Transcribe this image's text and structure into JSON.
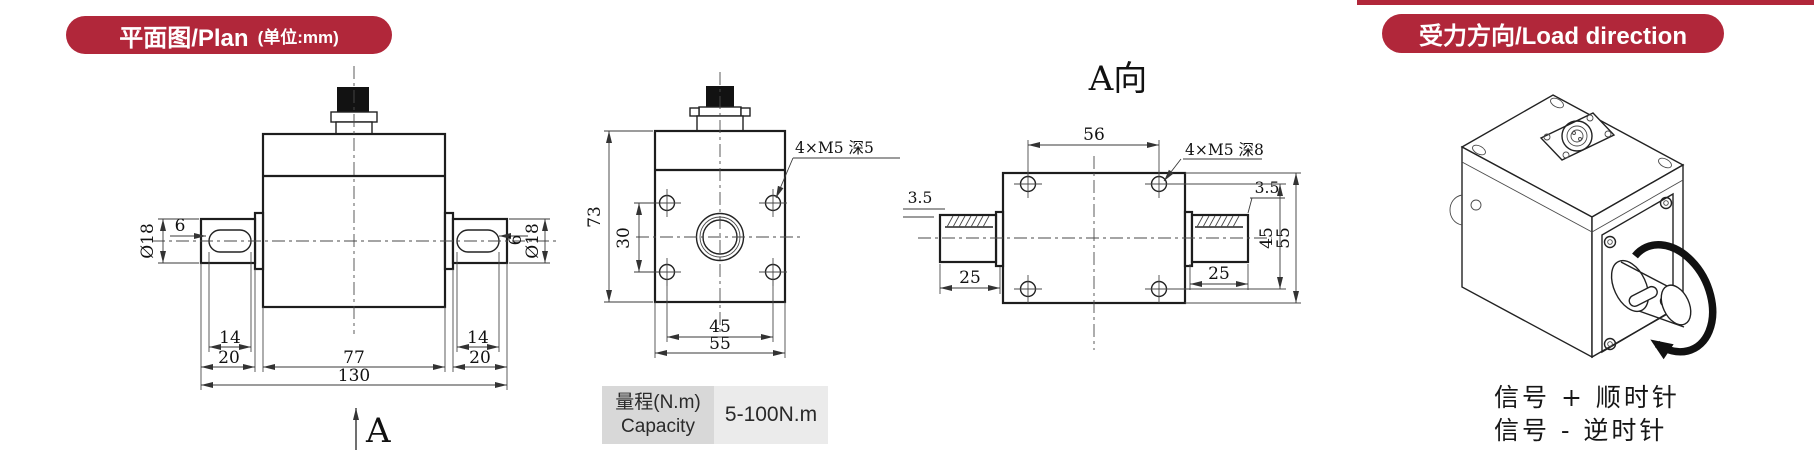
{
  "accent_color": "#b1273a",
  "banner_plan": {
    "title": "平面图/Plan",
    "unit": "(单位:mm)"
  },
  "banner_load": {
    "title": "受力方向/Load direction"
  },
  "front_view": {
    "dia_left": "Ø18",
    "offset_left": "6",
    "dia_right": "Ø18",
    "offset_right": "6",
    "key_left": "14",
    "shaft_left": "20",
    "body": "77",
    "key_right": "14",
    "shaft_right": "20",
    "total": "130",
    "arrow_label": "A"
  },
  "side_view": {
    "height": "73",
    "hole_v": "30",
    "hole_note": "4×M5 深5",
    "hole_h": "45",
    "width": "55"
  },
  "a_view": {
    "title": "A向",
    "hole_h": "56",
    "hole_note": "4×M5 深8",
    "key_depth_left": "3.5",
    "key_depth_right": "3.5",
    "hole_v": "45",
    "height": "55",
    "shaft_left": "25",
    "shaft_right": "25"
  },
  "capacity_table": {
    "label_cn": "量程(N.m)",
    "label_en": "Capacity",
    "value": "5-100N.m"
  },
  "load_direction": {
    "line1": "信号 + 顺时针",
    "line2": "信号 - 逆时针"
  }
}
